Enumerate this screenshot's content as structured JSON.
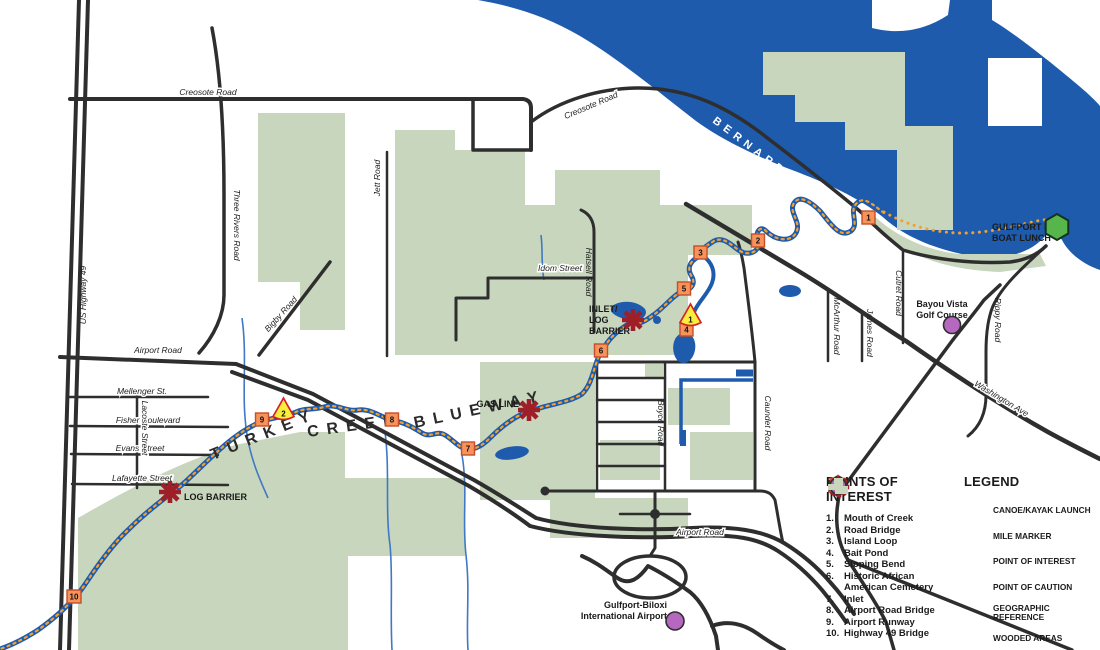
{
  "map_title": "Turkey Creek Blueway map",
  "water_labels": {
    "bernard_bayou": "BERNARD BAYOU"
  },
  "creek_label": {
    "word1": "TURKEY",
    "word2": "CREEK",
    "word3": "BLUEWAY"
  },
  "roads": {
    "creosote_w": "Creosote Road",
    "creosote_e": "Creosote Road",
    "us49": "US Highway 49",
    "three_rivers": "Three Rivers Road",
    "jett": "Jett Road",
    "idom": "Idom Street",
    "hatsell": "Hatsell Road",
    "airport_w": "Airport Road",
    "airport_s": "Airport Road",
    "mellenger": "Mellenger St.",
    "fisher": "Fisher Boulevard",
    "evans": "Evans Street",
    "lafayette": "Lafayette Street",
    "lacoste": "Lacoste Street",
    "bigby": "Bigby Road",
    "boyce": "Boyce Road",
    "caundet": "Caundet Road",
    "mcarthur": "McArthur Road",
    "james": "James Road",
    "cutret": "Cutret Road",
    "rippy": "Rippy Road",
    "washington": "Washington Ave"
  },
  "places": {
    "gulfport_lake_1": "GULFPORT LAKE",
    "gulfport_lake_2": "BOAT LUNCH",
    "bayou_vista_1": "Bayou Vista",
    "bayou_vista_2": "Golf Course",
    "airport_1": "Gulfport-Biloxi",
    "airport_2": "International Airport",
    "inlet_1": "INLET/",
    "inlet_2": "LOG",
    "inlet_3": "BARRIER",
    "gas_line": "GAS LINE",
    "log_barrier": "LOG BARRIER"
  },
  "markers": {
    "m1": "1",
    "m2": "2",
    "m3": "3",
    "m4": "4",
    "m5": "5",
    "m6": "6",
    "m7": "7",
    "m8": "8",
    "m9": "9",
    "m10": "10",
    "mile1": "1",
    "mile2": "2"
  },
  "poi": {
    "title": "POINTS OF INTEREST",
    "items": [
      {
        "num": "1.",
        "name": "Mouth of Creek"
      },
      {
        "num": "2.",
        "name": "Road Bridge"
      },
      {
        "num": "3.",
        "name": "Island Loop"
      },
      {
        "num": "4.",
        "name": "Bait Pond"
      },
      {
        "num": "5.",
        "name": "Sloping Bend"
      },
      {
        "num": "6.",
        "name": "Historic African American Cemetery"
      },
      {
        "num": "7.",
        "name": "Inlet"
      },
      {
        "num": "8.",
        "name": "Airport Road Bridge"
      },
      {
        "num": "9.",
        "name": "Airport Runway"
      },
      {
        "num": "10.",
        "name": "Highway 49 Bridge"
      }
    ]
  },
  "legend": {
    "title": "LEGEND",
    "items": [
      "CANOE/KAYAK LAUNCH",
      "MILE MARKER",
      "POINT OF INTEREST",
      "POINT OF CAUTION",
      "GEOGRAPHIC REFERENCE",
      "WOODED AREAS"
    ]
  },
  "colors": {
    "water": "#1e5bad",
    "woods": "#c7d6bd",
    "road": "#2e2e2e",
    "creek_dash": "#f2a02e",
    "poi_fill": "#f6925a",
    "poi_stroke": "#c44f2a",
    "mile_fill": "#f9ee3d",
    "mile_stroke": "#d62027",
    "caution": "#a32026",
    "launch": "#56b54b",
    "geo_ref": "#b668c0"
  }
}
